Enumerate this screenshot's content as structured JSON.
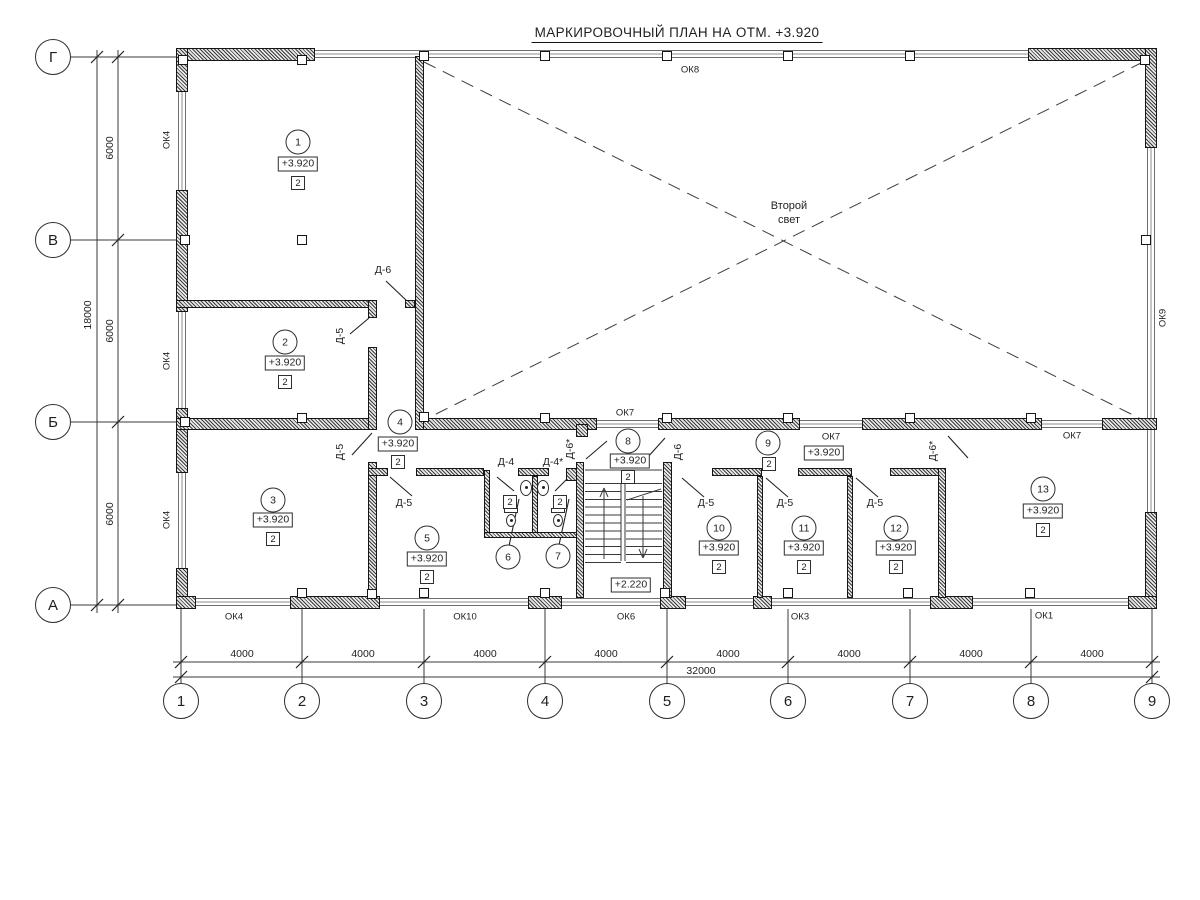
{
  "title": "МАРКИРОВОЧНЫЙ ПЛАН НА ОТМ. +3.920",
  "axes": {
    "rows": [
      "Г",
      "В",
      "Б",
      "А"
    ],
    "cols": [
      "1",
      "2",
      "3",
      "4",
      "5",
      "6",
      "7",
      "8",
      "9"
    ]
  },
  "dimensions": {
    "vertical_segments": [
      "6000",
      "6000",
      "6000"
    ],
    "vertical_total": "18000",
    "horizontal_segments": [
      "4000",
      "4000",
      "4000",
      "4000",
      "4000",
      "4000",
      "4000",
      "4000"
    ],
    "horizontal_total": "32000"
  },
  "room_numbers": [
    "1",
    "2",
    "3",
    "4",
    "5",
    "6",
    "7",
    "8",
    "9",
    "10",
    "11",
    "12",
    "13"
  ],
  "room_elevation": "+3.920",
  "room_type": "2",
  "stair_elevation": "+2.220",
  "second_light": {
    "line1": "Второй",
    "line2": "свет"
  },
  "window_labels": {
    "ok1": "ОК1",
    "ok3": "ОК3",
    "ok4": "ОК4",
    "ok6": "ОК6",
    "ok7": "ОК7",
    "ok8": "ОК8",
    "ok9": "ОК9",
    "ok10": "ОК10"
  },
  "door_labels": {
    "d4": "Д-4",
    "d4s": "Д-4*",
    "d5": "Д-5",
    "d6": "Д-6",
    "d6s": "Д-6*"
  }
}
